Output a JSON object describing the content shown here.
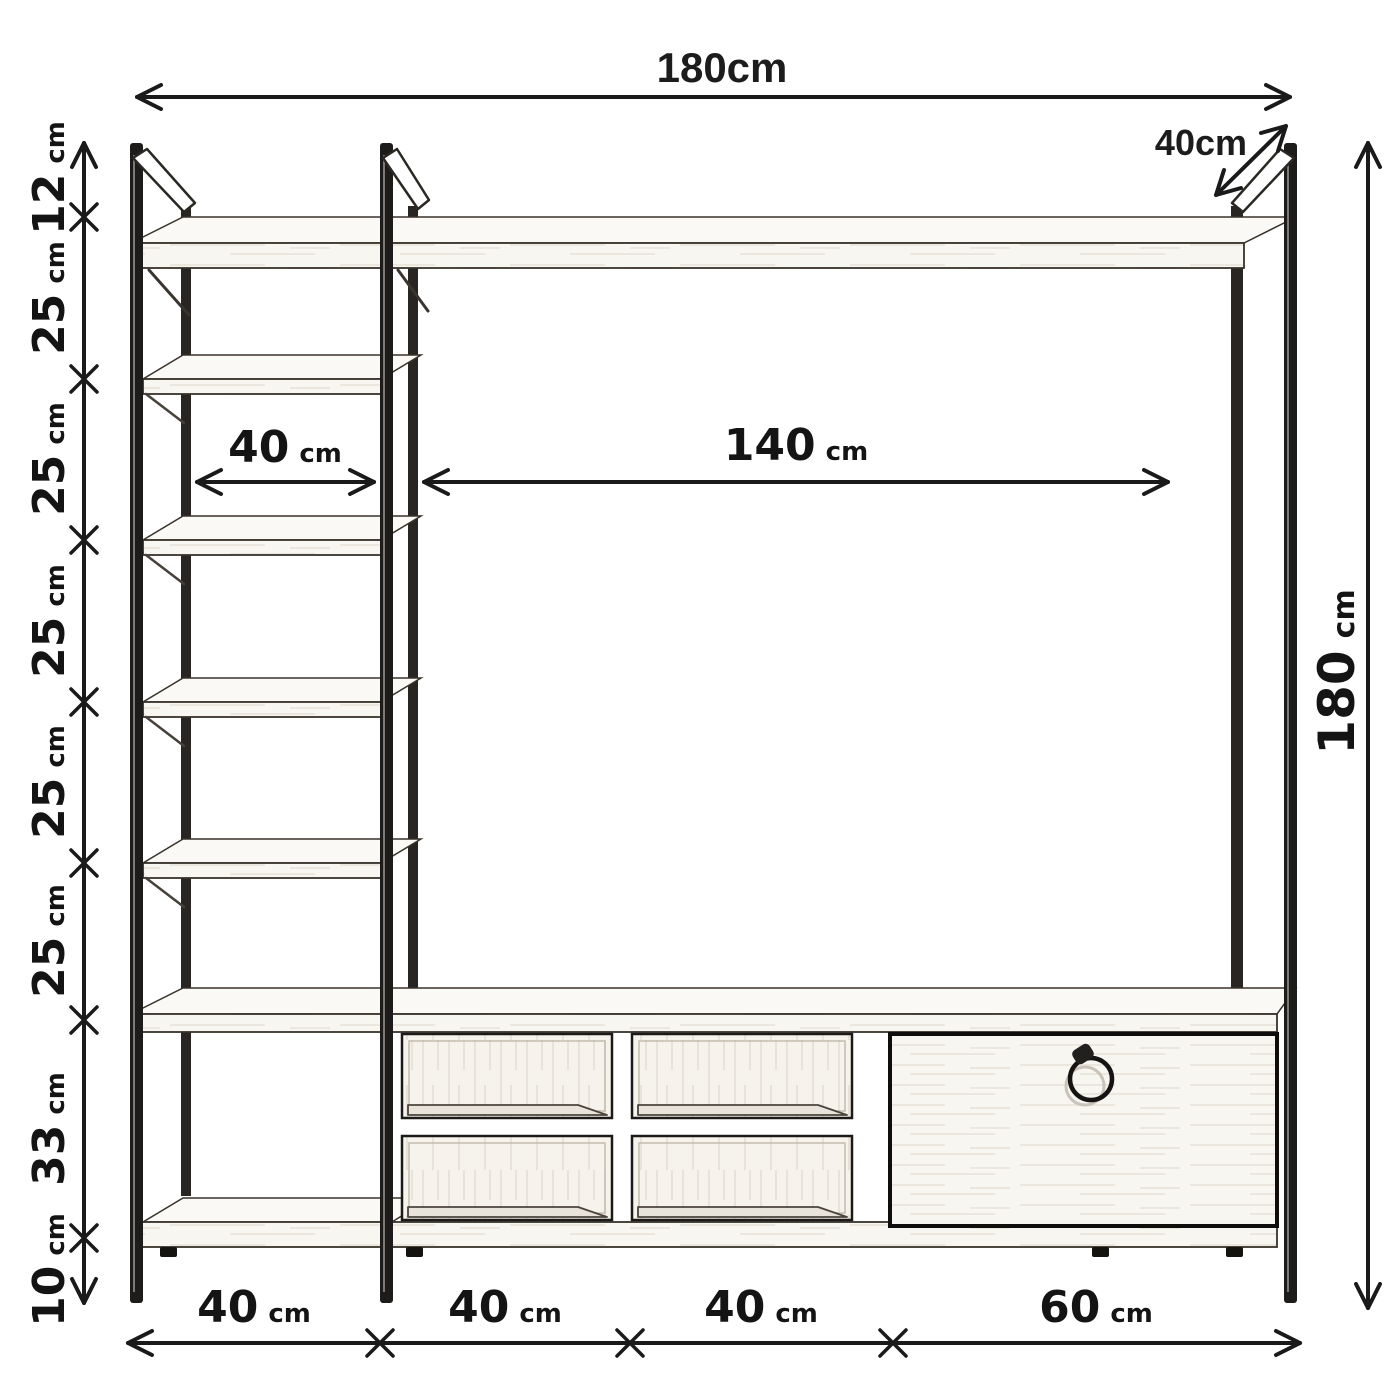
{
  "dimensions": {
    "overall_width": "180cm",
    "depth": "40cm",
    "overall_height": {
      "num": "180",
      "unit": "cm"
    },
    "left_heights": [
      {
        "num": "12",
        "unit": "cm"
      },
      {
        "num": "25",
        "unit": "cm"
      },
      {
        "num": "25",
        "unit": "cm"
      },
      {
        "num": "25",
        "unit": "cm"
      },
      {
        "num": "25",
        "unit": "cm"
      },
      {
        "num": "25",
        "unit": "cm"
      },
      {
        "num": "33",
        "unit": "cm"
      },
      {
        "num": "10",
        "unit": "cm"
      }
    ],
    "inner_widths": [
      {
        "num": "40",
        "unit": "cm"
      },
      {
        "num": "140",
        "unit": "cm"
      }
    ],
    "bottom_widths": [
      {
        "num": "40",
        "unit": "cm"
      },
      {
        "num": "40",
        "unit": "cm"
      },
      {
        "num": "40",
        "unit": "cm"
      },
      {
        "num": "60",
        "unit": "cm"
      }
    ]
  }
}
